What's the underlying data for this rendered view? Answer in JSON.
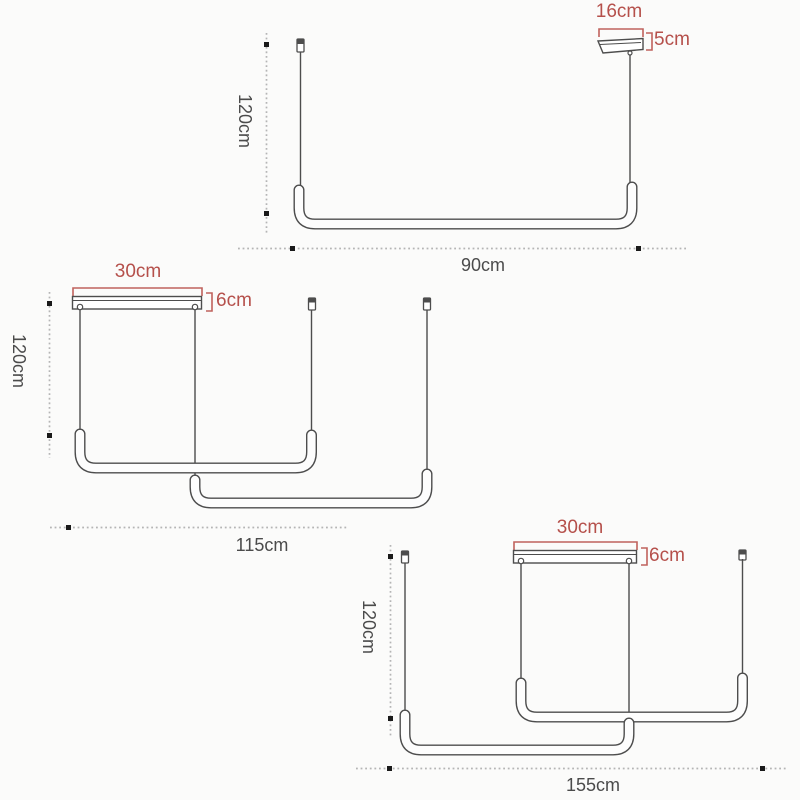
{
  "colors": {
    "bg": "#fbfbfa",
    "line": "#4d4d4d",
    "tube": "#fdfdfd",
    "text": "#4b4b4b",
    "red": "#b5504b",
    "red-line": "#c0625c",
    "dot": "#b5b5b5",
    "marker": "#1a1a1a"
  },
  "fixtures": [
    {
      "variant": "single bar pendant",
      "canopy_width": "16cm",
      "canopy_height": "5cm",
      "drop_height": "120cm",
      "bar_width": "90cm"
    },
    {
      "variant": "double bar pendant",
      "canopy_width": "30cm",
      "canopy_height": "6cm",
      "drop_height": "120cm",
      "bar_width": "115cm"
    },
    {
      "variant": "double bar pendant",
      "canopy_width": "30cm",
      "canopy_height": "6cm",
      "drop_height": "120cm",
      "bar_width": "155cm"
    }
  ]
}
